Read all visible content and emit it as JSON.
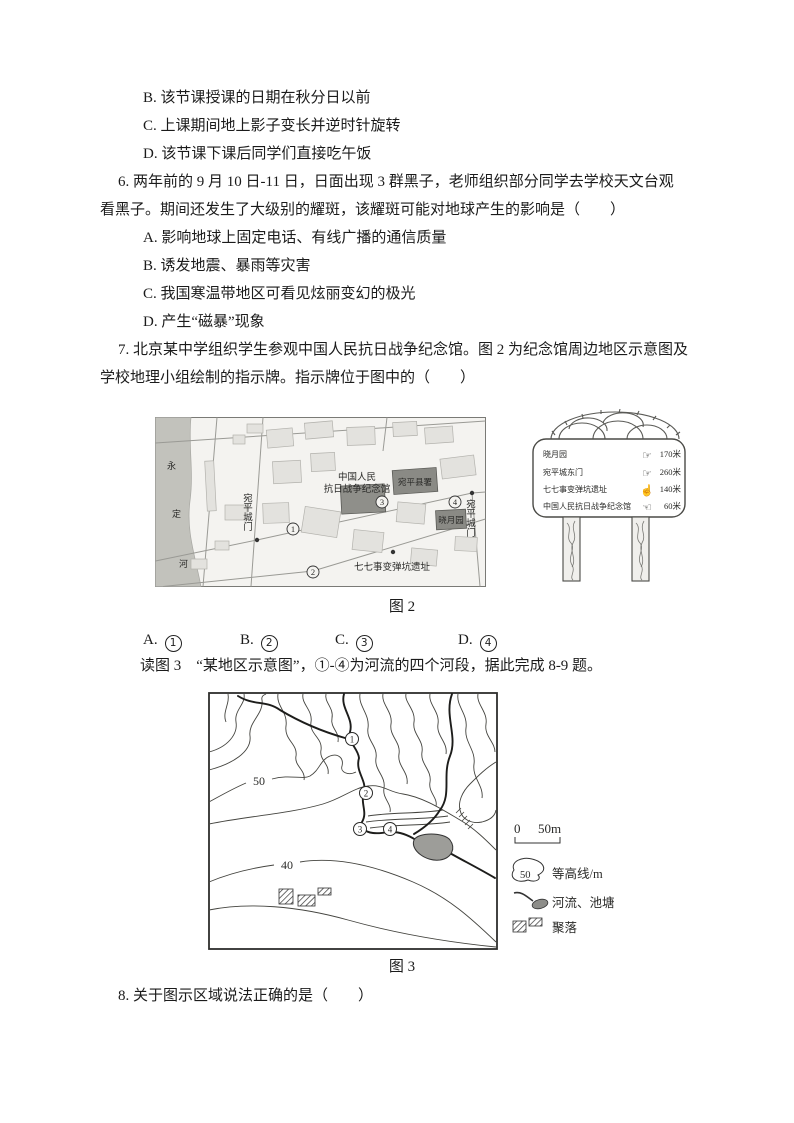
{
  "questions": {
    "q5_options": [
      "B. 该节课授课的日期在秋分日以前",
      "C. 上课期间地上影子变长并逆时针旋转",
      "D. 该节课下课后同学们直接吃午饭"
    ],
    "q6_stem_line1": "6. 两年前的 9 月 10 日-11 日，日面出现 3 群黑子，老师组织部分同学去学校天文台观",
    "q6_stem_line2": "看黑子。期间还发生了大级别的耀斑，该耀斑可能对地球产生的影响是（　　）",
    "q6_options": [
      "A. 影响地球上固定电话、有线广播的通信质量",
      "B. 诱发地震、暴雨等灾害",
      "C. 我国寒温带地区可看见炫丽变幻的极光",
      "D. 产生“磁暴”现象"
    ],
    "q7_stem_line1": "7. 北京某中学组织学生参观中国人民抗日战争纪念馆。图 2 为纪念馆周边地区示意图及",
    "q7_stem_line2": "学校地理小组绘制的指示牌。指示牌位于图中的（　　）",
    "q7_answers": [
      {
        "label": "A.",
        "num": "1"
      },
      {
        "label": "B.",
        "num": "2"
      },
      {
        "label": "C.",
        "num": "3"
      },
      {
        "label": "D.",
        "num": "4"
      }
    ],
    "fig3_intro": "读图 3　“某地区示意图”，①-④为河流的四个河段，据此完成 8-9 题。",
    "q8_stem": "8. 关于图示区域说法正确的是（　　）"
  },
  "fig2": {
    "caption": "图 2",
    "map": {
      "river_name_chars": [
        "永",
        "定",
        "河"
      ],
      "memorial_line1": "中国人民",
      "memorial_line2": "抗日战争纪念馆",
      "county_office": "宛平县署",
      "xiaoyue_garden": "晓月园",
      "gate_left": "宛平城门",
      "gate_right": "宛平城门",
      "crater_site": "七七事变弹坑遗址",
      "markers": [
        "1",
        "2",
        "3",
        "4"
      ]
    },
    "signpost": {
      "rows": [
        {
          "name": "晓月园",
          "icon": "pointing-hand-right",
          "glyph": "☞",
          "distance": "170米"
        },
        {
          "name": "宛平城东门",
          "icon": "pointing-hand-right",
          "glyph": "☞",
          "distance": "260米"
        },
        {
          "name": "七七事变弹坑遗址",
          "icon": "pointing-hand-up",
          "glyph": "☝",
          "distance": "140米"
        },
        {
          "name": "中国人民抗日战争纪念馆",
          "icon": "pointing-hand-left",
          "glyph": "☜",
          "distance": "60米"
        }
      ]
    }
  },
  "fig3": {
    "caption": "图 3",
    "contour_label_50": "50",
    "contour_label_40": "40",
    "markers": [
      "1",
      "2",
      "3",
      "4"
    ],
    "legend": {
      "scale_start": "0",
      "scale_end": "50m",
      "contour_symbol_value": "50",
      "contour_label": "等高线/m",
      "river_pond_label": "河流、池塘",
      "settlement_label": "聚落"
    }
  }
}
